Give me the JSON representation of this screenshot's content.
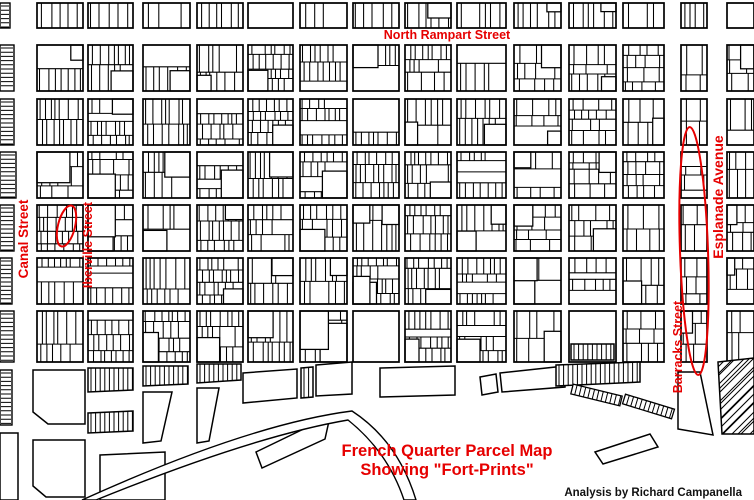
{
  "labels": {
    "north_rampart": "North Rampart Street",
    "canal": "Canal Street",
    "iberville": "Iberville Street",
    "esplanade": "Esplanade Avenue",
    "barracks": "Barracks Street",
    "title_line1": "French Quarter Parcel Map",
    "title_line2": "Showing \"Fort-Prints\"",
    "credit": "Analysis by Richard Campanella"
  },
  "colors": {
    "annotation_red": "#E60000",
    "parcel_line": "#000000",
    "background": "#FFFFFF",
    "credit_ink": "#111111"
  },
  "annotations": {
    "small_fortprint": {
      "cx": 66.5,
      "cy": 226,
      "rx": 8.5,
      "ry": 21,
      "rotate": 14,
      "stroke_width": 2
    },
    "large_fortprint": {
      "cx": 694,
      "cy": 251,
      "rx": 14,
      "ry": 124,
      "rotate": -2,
      "stroke_width": 2
    }
  },
  "map": {
    "width": 754,
    "height": 500,
    "seed": 11,
    "col_lefts": [
      37,
      88,
      143,
      197,
      248,
      300,
      353,
      405,
      457,
      514,
      569,
      623,
      681,
      727
    ],
    "col_widths": [
      46,
      45,
      47,
      46,
      45,
      47,
      46,
      46,
      49,
      47,
      47,
      41,
      26,
      27
    ],
    "row_tops": [
      3,
      45,
      99,
      152,
      205,
      258,
      311
    ],
    "row_heights": [
      25,
      46,
      46,
      46,
      46,
      46,
      51
    ],
    "chunky_from_col": 9,
    "special_blocks": [
      {
        "col": 6,
        "row": 6,
        "style": "empty"
      },
      {
        "col": 10,
        "row": 6,
        "style": "empty"
      },
      {
        "col": 13,
        "row": 0,
        "style": "empty"
      },
      {
        "col": 0,
        "row": 3,
        "style": "sparse"
      },
      {
        "col": 1,
        "row": 3,
        "style": "sparse"
      },
      {
        "col": 1,
        "row": 4,
        "style": "sparse"
      },
      {
        "col": 5,
        "row": 6,
        "style": "sparse"
      }
    ],
    "edge_strips": [
      [
        0,
        3,
        10,
        25
      ],
      [
        0,
        45,
        14,
        46
      ],
      [
        0,
        99,
        14,
        46
      ],
      [
        0,
        152,
        16,
        46
      ],
      [
        0,
        205,
        14,
        46
      ],
      [
        0,
        258,
        12,
        46
      ],
      [
        0,
        311,
        14,
        51
      ],
      [
        0,
        370,
        12,
        55
      ]
    ],
    "fan_shapes": [
      {
        "points": [
          [
            33,
            370
          ],
          [
            85,
            370
          ],
          [
            85,
            424
          ],
          [
            48,
            424
          ],
          [
            33,
            412
          ]
        ],
        "hatch": null
      },
      {
        "points": [
          [
            88,
            368
          ],
          [
            133,
            368
          ],
          [
            133,
            390
          ],
          [
            88,
            392
          ]
        ],
        "hatch": "v"
      },
      {
        "points": [
          [
            88,
            413
          ],
          [
            133,
            411
          ],
          [
            133,
            431
          ],
          [
            88,
            433
          ]
        ],
        "hatch": "v"
      },
      {
        "points": [
          [
            143,
            366
          ],
          [
            188,
            366
          ],
          [
            188,
            384
          ],
          [
            143,
            386
          ]
        ],
        "hatch": "v"
      },
      {
        "points": [
          [
            143,
            392
          ],
          [
            172,
            392
          ],
          [
            161,
            441
          ],
          [
            143,
            443
          ]
        ],
        "hatch": null
      },
      {
        "points": [
          [
            197,
            364
          ],
          [
            241,
            364
          ],
          [
            241,
            380
          ],
          [
            197,
            383
          ]
        ],
        "hatch": "v"
      },
      {
        "points": [
          [
            197,
            388
          ],
          [
            219,
            388
          ],
          [
            209,
            441
          ],
          [
            197,
            443
          ]
        ],
        "hatch": null
      },
      {
        "points": [
          [
            243,
            373
          ],
          [
            297,
            369
          ],
          [
            297,
            398
          ],
          [
            243,
            403
          ]
        ],
        "hatch": null
      },
      {
        "points": [
          [
            301,
            368
          ],
          [
            313,
            367
          ],
          [
            313,
            397
          ],
          [
            301,
            398
          ]
        ],
        "hatch": "v"
      },
      {
        "points": [
          [
            316,
            365
          ],
          [
            352,
            362
          ],
          [
            352,
            394
          ],
          [
            316,
            396
          ]
        ],
        "hatch": null
      },
      {
        "points": [
          [
            380,
            368
          ],
          [
            455,
            366
          ],
          [
            455,
            395
          ],
          [
            380,
            397
          ]
        ],
        "hatch": null
      },
      {
        "points": [
          [
            480,
            377
          ],
          [
            496,
            374
          ],
          [
            498,
            392
          ],
          [
            482,
            395
          ]
        ],
        "hatch": null
      },
      {
        "points": [
          [
            500,
            373
          ],
          [
            565,
            366
          ],
          [
            565,
            387
          ],
          [
            502,
            392
          ]
        ],
        "hatch": null
      },
      {
        "points": [
          [
            556,
            365
          ],
          [
            640,
            362
          ],
          [
            640,
            382
          ],
          [
            556,
            386
          ]
        ],
        "hatch": "v"
      },
      {
        "points": [
          [
            571,
            344
          ],
          [
            614,
            344
          ],
          [
            614,
            360
          ],
          [
            571,
            360
          ]
        ],
        "hatch": "v"
      },
      {
        "points": [
          [
            678,
            372
          ],
          [
            700,
            372
          ],
          [
            713,
            435
          ],
          [
            678,
            429
          ]
        ],
        "hatch": null
      },
      {
        "points": [
          [
            718,
            362
          ],
          [
            754,
            358
          ],
          [
            754,
            434
          ],
          [
            722,
            434
          ]
        ],
        "hatch": "d"
      },
      {
        "points": [
          [
            595,
            452
          ],
          [
            650,
            434
          ],
          [
            658,
            447
          ],
          [
            603,
            464
          ]
        ],
        "hatch": null
      },
      {
        "points": [
          [
            256,
            452
          ],
          [
            316,
            423
          ],
          [
            318,
            417
          ],
          [
            329,
            421
          ],
          [
            325,
            439
          ],
          [
            262,
            468
          ]
        ],
        "hatch": null
      },
      {
        "points": [
          [
            33,
            440
          ],
          [
            85,
            440
          ],
          [
            85,
            497
          ],
          [
            46,
            497
          ],
          [
            33,
            486
          ]
        ],
        "hatch": null
      },
      {
        "points": [
          [
            100,
            455
          ],
          [
            165,
            452
          ],
          [
            165,
            500
          ],
          [
            100,
            500
          ]
        ],
        "hatch": null
      },
      {
        "points": [
          [
            0,
            433
          ],
          [
            18,
            433
          ],
          [
            18,
            500
          ],
          [
            0,
            500
          ]
        ],
        "hatch": null
      }
    ],
    "ladders": [
      [
        572,
        389,
        621,
        401,
        5
      ],
      [
        624,
        399,
        673,
        414,
        5
      ]
    ],
    "river_arc": "M82,500 Q250,424 352,411 Q398,441 416,500 L404,500 Q388,452 348,420 Q254,436 96,500 Z"
  }
}
